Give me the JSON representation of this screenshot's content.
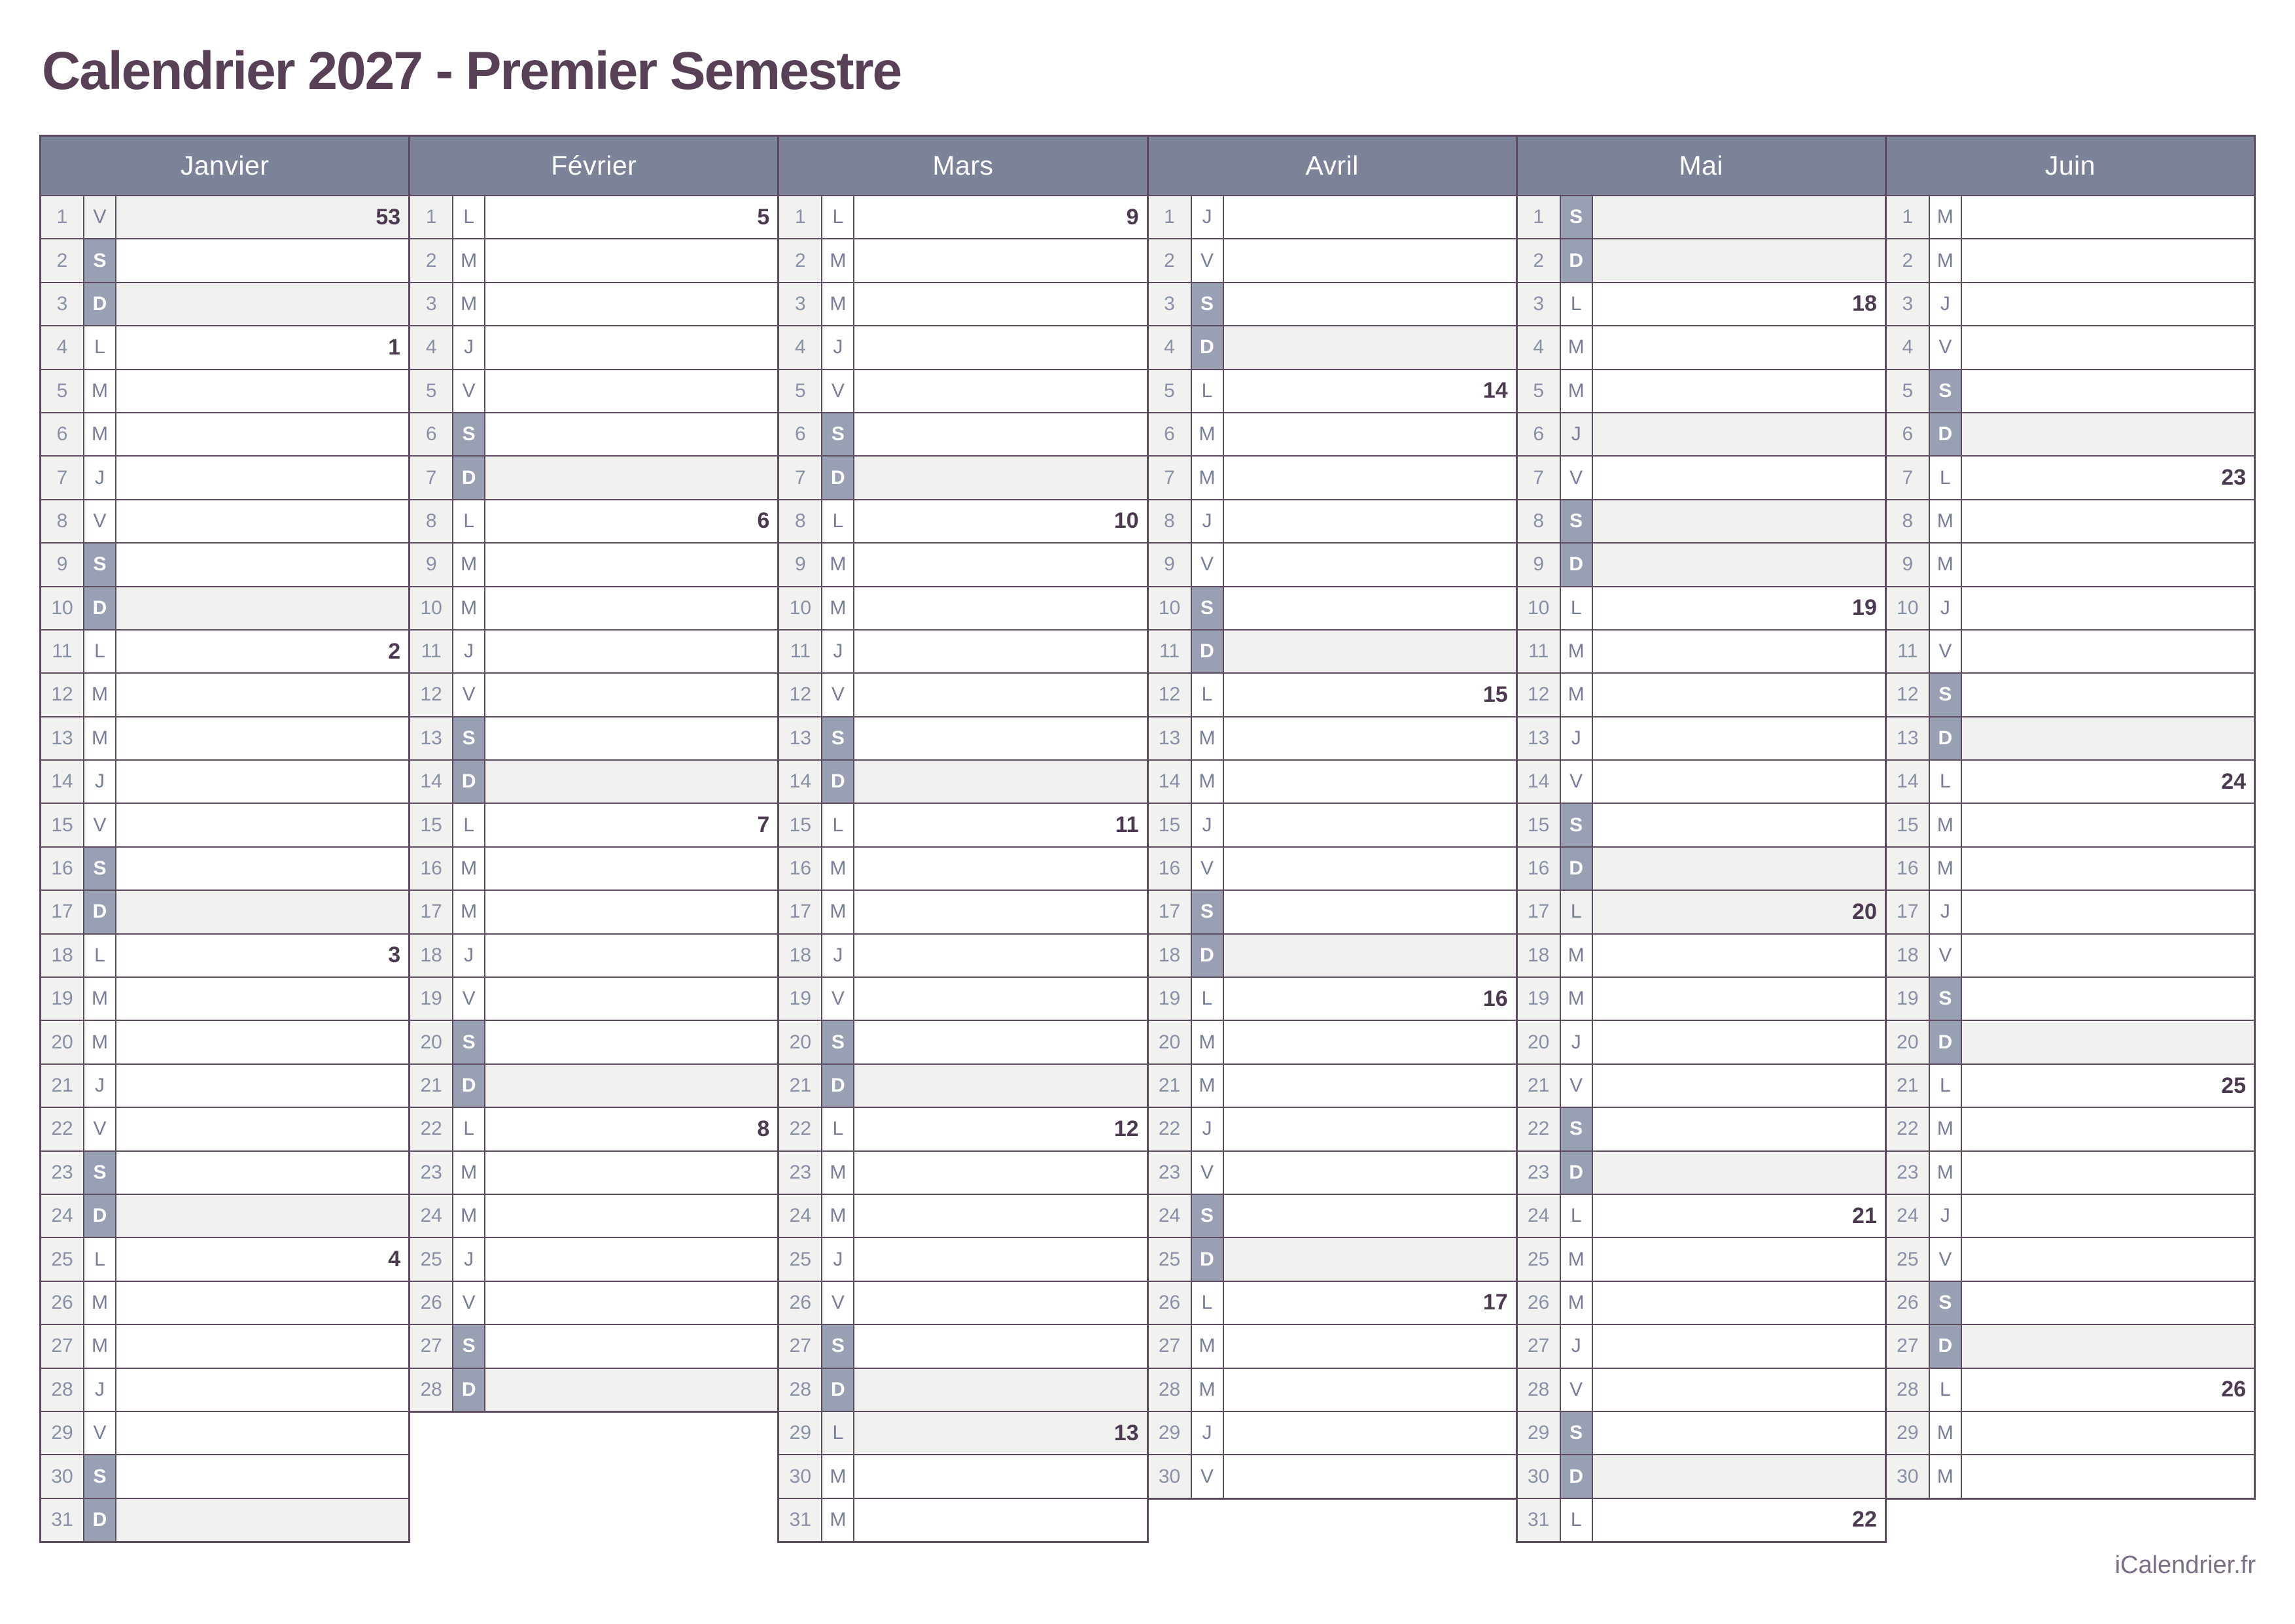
{
  "title": "Calendrier 2027 - Premier Semestre",
  "footer": "iCalendrier.fr",
  "colors": {
    "title_text": "#584157",
    "month_header_bg": "#7c8298",
    "month_header_text": "#ffffff",
    "weekend_letter_bg": "#9aa0b4",
    "weekend_letter_text": "#ffffff",
    "sunday_holiday_row_bg": "#f0f0ee",
    "day_number_col_bg": "#f1f1f0",
    "day_number_text": "#8890a6",
    "day_letter_text": "#777e98",
    "week_number_text": "#4c3b50",
    "grid_border": "#5d4b60",
    "footer_text": "#7b6d86"
  },
  "months": [
    {
      "name": "Janvier",
      "days": [
        {
          "d": "1",
          "w": "V",
          "wk": "53",
          "off": true
        },
        {
          "d": "2",
          "w": "S"
        },
        {
          "d": "3",
          "w": "D",
          "off": true
        },
        {
          "d": "4",
          "w": "L",
          "wk": "1"
        },
        {
          "d": "5",
          "w": "M"
        },
        {
          "d": "6",
          "w": "M"
        },
        {
          "d": "7",
          "w": "J"
        },
        {
          "d": "8",
          "w": "V"
        },
        {
          "d": "9",
          "w": "S"
        },
        {
          "d": "10",
          "w": "D",
          "off": true
        },
        {
          "d": "11",
          "w": "L",
          "wk": "2"
        },
        {
          "d": "12",
          "w": "M"
        },
        {
          "d": "13",
          "w": "M"
        },
        {
          "d": "14",
          "w": "J"
        },
        {
          "d": "15",
          "w": "V"
        },
        {
          "d": "16",
          "w": "S"
        },
        {
          "d": "17",
          "w": "D",
          "off": true
        },
        {
          "d": "18",
          "w": "L",
          "wk": "3"
        },
        {
          "d": "19",
          "w": "M"
        },
        {
          "d": "20",
          "w": "M"
        },
        {
          "d": "21",
          "w": "J"
        },
        {
          "d": "22",
          "w": "V"
        },
        {
          "d": "23",
          "w": "S"
        },
        {
          "d": "24",
          "w": "D",
          "off": true
        },
        {
          "d": "25",
          "w": "L",
          "wk": "4"
        },
        {
          "d": "26",
          "w": "M"
        },
        {
          "d": "27",
          "w": "M"
        },
        {
          "d": "28",
          "w": "J"
        },
        {
          "d": "29",
          "w": "V"
        },
        {
          "d": "30",
          "w": "S"
        },
        {
          "d": "31",
          "w": "D",
          "off": true
        }
      ]
    },
    {
      "name": "Février",
      "days": [
        {
          "d": "1",
          "w": "L",
          "wk": "5"
        },
        {
          "d": "2",
          "w": "M"
        },
        {
          "d": "3",
          "w": "M"
        },
        {
          "d": "4",
          "w": "J"
        },
        {
          "d": "5",
          "w": "V"
        },
        {
          "d": "6",
          "w": "S"
        },
        {
          "d": "7",
          "w": "D",
          "off": true
        },
        {
          "d": "8",
          "w": "L",
          "wk": "6"
        },
        {
          "d": "9",
          "w": "M"
        },
        {
          "d": "10",
          "w": "M"
        },
        {
          "d": "11",
          "w": "J"
        },
        {
          "d": "12",
          "w": "V"
        },
        {
          "d": "13",
          "w": "S"
        },
        {
          "d": "14",
          "w": "D",
          "off": true
        },
        {
          "d": "15",
          "w": "L",
          "wk": "7"
        },
        {
          "d": "16",
          "w": "M"
        },
        {
          "d": "17",
          "w": "M"
        },
        {
          "d": "18",
          "w": "J"
        },
        {
          "d": "19",
          "w": "V"
        },
        {
          "d": "20",
          "w": "S"
        },
        {
          "d": "21",
          "w": "D",
          "off": true
        },
        {
          "d": "22",
          "w": "L",
          "wk": "8"
        },
        {
          "d": "23",
          "w": "M"
        },
        {
          "d": "24",
          "w": "M"
        },
        {
          "d": "25",
          "w": "J"
        },
        {
          "d": "26",
          "w": "V"
        },
        {
          "d": "27",
          "w": "S"
        },
        {
          "d": "28",
          "w": "D",
          "off": true
        }
      ]
    },
    {
      "name": "Mars",
      "days": [
        {
          "d": "1",
          "w": "L",
          "wk": "9"
        },
        {
          "d": "2",
          "w": "M"
        },
        {
          "d": "3",
          "w": "M"
        },
        {
          "d": "4",
          "w": "J"
        },
        {
          "d": "5",
          "w": "V"
        },
        {
          "d": "6",
          "w": "S"
        },
        {
          "d": "7",
          "w": "D",
          "off": true
        },
        {
          "d": "8",
          "w": "L",
          "wk": "10"
        },
        {
          "d": "9",
          "w": "M"
        },
        {
          "d": "10",
          "w": "M"
        },
        {
          "d": "11",
          "w": "J"
        },
        {
          "d": "12",
          "w": "V"
        },
        {
          "d": "13",
          "w": "S"
        },
        {
          "d": "14",
          "w": "D",
          "off": true
        },
        {
          "d": "15",
          "w": "L",
          "wk": "11"
        },
        {
          "d": "16",
          "w": "M"
        },
        {
          "d": "17",
          "w": "M"
        },
        {
          "d": "18",
          "w": "J"
        },
        {
          "d": "19",
          "w": "V"
        },
        {
          "d": "20",
          "w": "S"
        },
        {
          "d": "21",
          "w": "D",
          "off": true
        },
        {
          "d": "22",
          "w": "L",
          "wk": "12"
        },
        {
          "d": "23",
          "w": "M"
        },
        {
          "d": "24",
          "w": "M"
        },
        {
          "d": "25",
          "w": "J"
        },
        {
          "d": "26",
          "w": "V"
        },
        {
          "d": "27",
          "w": "S"
        },
        {
          "d": "28",
          "w": "D",
          "off": true
        },
        {
          "d": "29",
          "w": "L",
          "wk": "13",
          "off": true
        },
        {
          "d": "30",
          "w": "M"
        },
        {
          "d": "31",
          "w": "M"
        }
      ]
    },
    {
      "name": "Avril",
      "days": [
        {
          "d": "1",
          "w": "J"
        },
        {
          "d": "2",
          "w": "V"
        },
        {
          "d": "3",
          "w": "S"
        },
        {
          "d": "4",
          "w": "D",
          "off": true
        },
        {
          "d": "5",
          "w": "L",
          "wk": "14"
        },
        {
          "d": "6",
          "w": "M"
        },
        {
          "d": "7",
          "w": "M"
        },
        {
          "d": "8",
          "w": "J"
        },
        {
          "d": "9",
          "w": "V"
        },
        {
          "d": "10",
          "w": "S"
        },
        {
          "d": "11",
          "w": "D",
          "off": true
        },
        {
          "d": "12",
          "w": "L",
          "wk": "15"
        },
        {
          "d": "13",
          "w": "M"
        },
        {
          "d": "14",
          "w": "M"
        },
        {
          "d": "15",
          "w": "J"
        },
        {
          "d": "16",
          "w": "V"
        },
        {
          "d": "17",
          "w": "S"
        },
        {
          "d": "18",
          "w": "D",
          "off": true
        },
        {
          "d": "19",
          "w": "L",
          "wk": "16"
        },
        {
          "d": "20",
          "w": "M"
        },
        {
          "d": "21",
          "w": "M"
        },
        {
          "d": "22",
          "w": "J"
        },
        {
          "d": "23",
          "w": "V"
        },
        {
          "d": "24",
          "w": "S"
        },
        {
          "d": "25",
          "w": "D",
          "off": true
        },
        {
          "d": "26",
          "w": "L",
          "wk": "17"
        },
        {
          "d": "27",
          "w": "M"
        },
        {
          "d": "28",
          "w": "M"
        },
        {
          "d": "29",
          "w": "J"
        },
        {
          "d": "30",
          "w": "V"
        }
      ]
    },
    {
      "name": "Mai",
      "days": [
        {
          "d": "1",
          "w": "S",
          "off": true
        },
        {
          "d": "2",
          "w": "D",
          "off": true
        },
        {
          "d": "3",
          "w": "L",
          "wk": "18"
        },
        {
          "d": "4",
          "w": "M"
        },
        {
          "d": "5",
          "w": "M"
        },
        {
          "d": "6",
          "w": "J",
          "off": true
        },
        {
          "d": "7",
          "w": "V"
        },
        {
          "d": "8",
          "w": "S",
          "off": true
        },
        {
          "d": "9",
          "w": "D",
          "off": true
        },
        {
          "d": "10",
          "w": "L",
          "wk": "19"
        },
        {
          "d": "11",
          "w": "M"
        },
        {
          "d": "12",
          "w": "M"
        },
        {
          "d": "13",
          "w": "J"
        },
        {
          "d": "14",
          "w": "V"
        },
        {
          "d": "15",
          "w": "S"
        },
        {
          "d": "16",
          "w": "D",
          "off": true
        },
        {
          "d": "17",
          "w": "L",
          "wk": "20",
          "off": true
        },
        {
          "d": "18",
          "w": "M"
        },
        {
          "d": "19",
          "w": "M"
        },
        {
          "d": "20",
          "w": "J"
        },
        {
          "d": "21",
          "w": "V"
        },
        {
          "d": "22",
          "w": "S"
        },
        {
          "d": "23",
          "w": "D",
          "off": true
        },
        {
          "d": "24",
          "w": "L",
          "wk": "21"
        },
        {
          "d": "25",
          "w": "M"
        },
        {
          "d": "26",
          "w": "M"
        },
        {
          "d": "27",
          "w": "J"
        },
        {
          "d": "28",
          "w": "V"
        },
        {
          "d": "29",
          "w": "S"
        },
        {
          "d": "30",
          "w": "D",
          "off": true
        },
        {
          "d": "31",
          "w": "L",
          "wk": "22"
        }
      ]
    },
    {
      "name": "Juin",
      "days": [
        {
          "d": "1",
          "w": "M"
        },
        {
          "d": "2",
          "w": "M"
        },
        {
          "d": "3",
          "w": "J"
        },
        {
          "d": "4",
          "w": "V"
        },
        {
          "d": "5",
          "w": "S"
        },
        {
          "d": "6",
          "w": "D",
          "off": true
        },
        {
          "d": "7",
          "w": "L",
          "wk": "23"
        },
        {
          "d": "8",
          "w": "M"
        },
        {
          "d": "9",
          "w": "M"
        },
        {
          "d": "10",
          "w": "J"
        },
        {
          "d": "11",
          "w": "V"
        },
        {
          "d": "12",
          "w": "S"
        },
        {
          "d": "13",
          "w": "D",
          "off": true
        },
        {
          "d": "14",
          "w": "L",
          "wk": "24"
        },
        {
          "d": "15",
          "w": "M"
        },
        {
          "d": "16",
          "w": "M"
        },
        {
          "d": "17",
          "w": "J"
        },
        {
          "d": "18",
          "w": "V"
        },
        {
          "d": "19",
          "w": "S"
        },
        {
          "d": "20",
          "w": "D",
          "off": true
        },
        {
          "d": "21",
          "w": "L",
          "wk": "25"
        },
        {
          "d": "22",
          "w": "M"
        },
        {
          "d": "23",
          "w": "M"
        },
        {
          "d": "24",
          "w": "J"
        },
        {
          "d": "25",
          "w": "V"
        },
        {
          "d": "26",
          "w": "S"
        },
        {
          "d": "27",
          "w": "D",
          "off": true
        },
        {
          "d": "28",
          "w": "L",
          "wk": "26"
        },
        {
          "d": "29",
          "w": "M"
        },
        {
          "d": "30",
          "w": "M"
        }
      ]
    }
  ]
}
